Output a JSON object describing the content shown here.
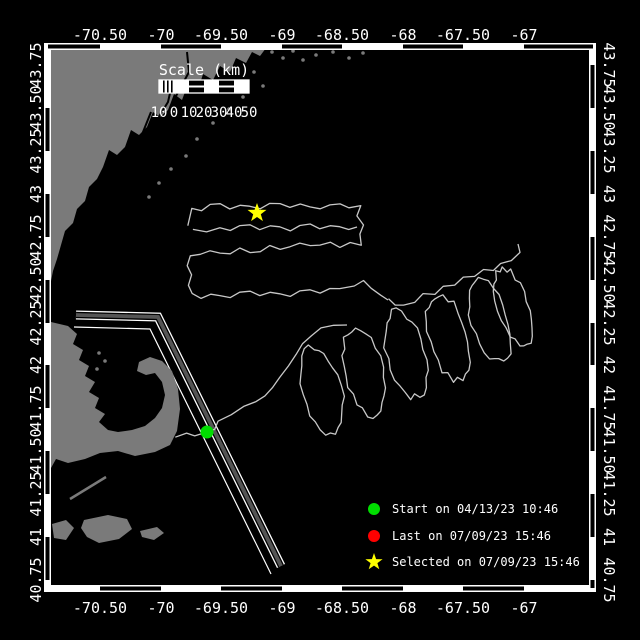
{
  "map": {
    "scale_bar": {
      "title": "Scale (km)",
      "tick_labels": [
        "10",
        "0",
        "10",
        "20",
        "30",
        "40",
        "50"
      ]
    },
    "axes": {
      "lon_labels": [
        "-70.50",
        "-70",
        "-69.50",
        "-69",
        "-68.50",
        "-68",
        "-67.50",
        "-67"
      ],
      "lat_labels": [
        "43.75",
        "43.50",
        "43.25",
        "43",
        "42.75",
        "42.50",
        "42.25",
        "42",
        "41.75",
        "41.50",
        "41.25",
        "41",
        "40.75"
      ]
    },
    "legend": {
      "items": [
        {
          "marker": "circle",
          "color": "#00dd00",
          "label": "Start on 04/13/23 10:46"
        },
        {
          "marker": "circle",
          "color": "#ff0000",
          "label": "Last on 07/09/23 15:46"
        },
        {
          "marker": "star",
          "color": "#ffff00",
          "label": "Selected on 07/09/23 15:46"
        }
      ]
    },
    "markers": {
      "start": {
        "shape": "circle",
        "color": "#00dd00"
      },
      "selected": {
        "shape": "star",
        "color": "#ffff00"
      }
    },
    "colors": {
      "ocean": "#000000",
      "land": "#7a7a7a",
      "track": "#c8c8c8",
      "frame": "#ffffff",
      "lane_fill": "#555555",
      "text": "#ffffff"
    }
  }
}
